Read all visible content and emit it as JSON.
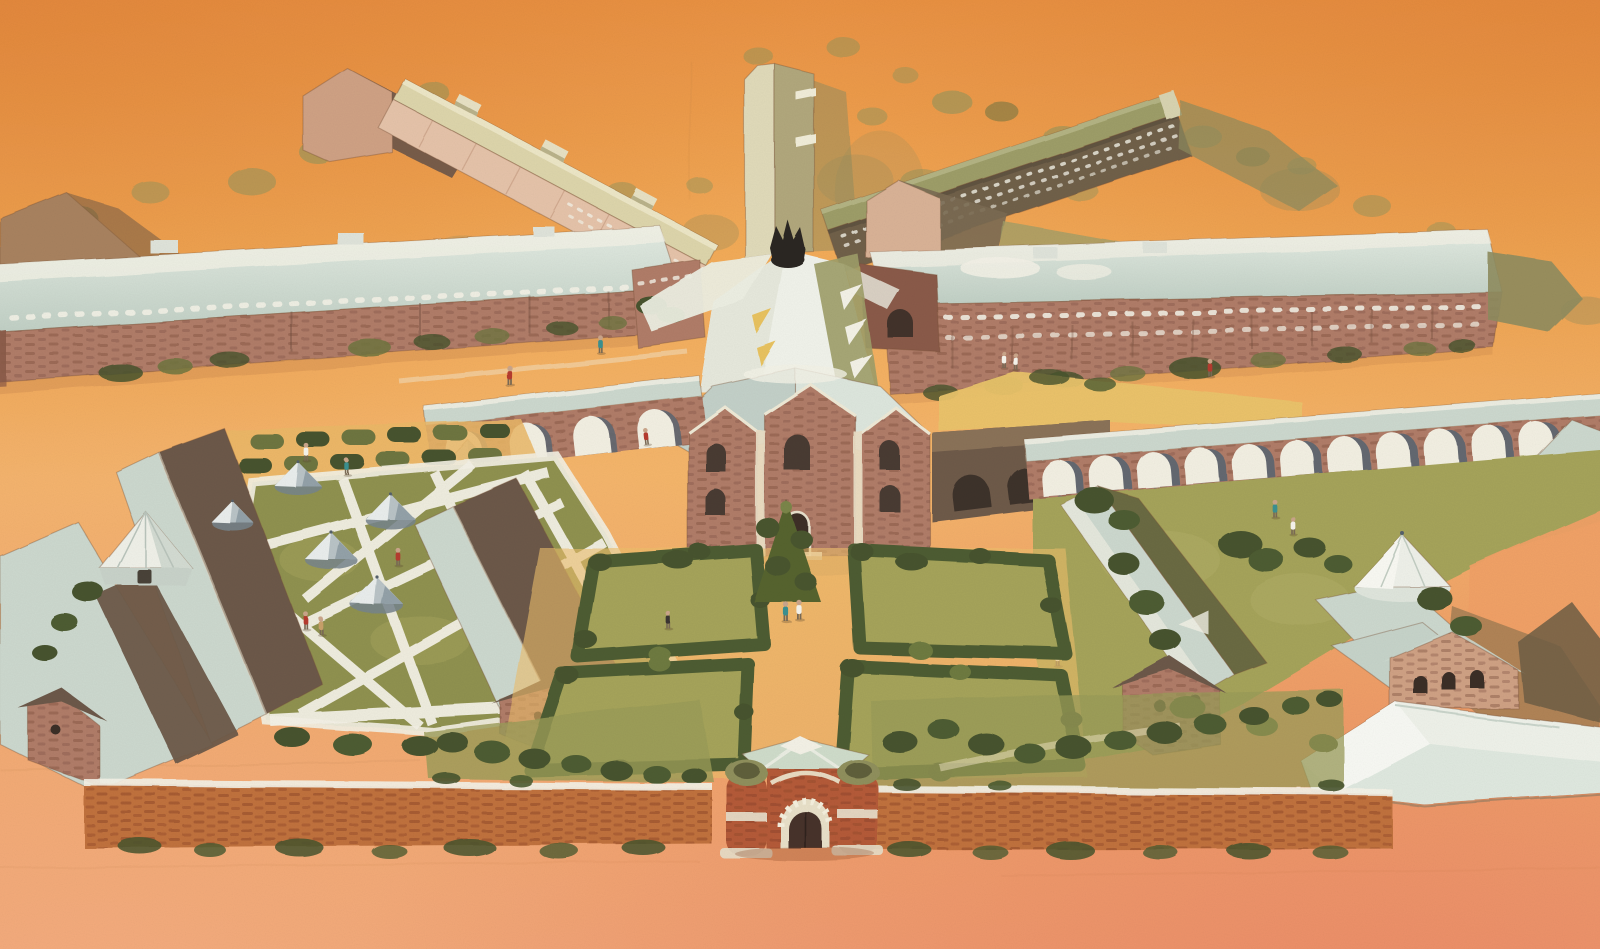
{
  "meta": {
    "alt": "Aerial watercolour illustration of a walled radial prison complex: central watchtower with radiating cell-block wings, long perimeter cell blocks, arcaded inner walls, a brick chapel, formal hedged gardens, a zig-zag exercise yard with round tents, workshop buildings, and a turreted brick gatehouse in the south wall"
  },
  "scene": {
    "elements": [
      "central-watchtower",
      "radial-cell-block-wings",
      "west-perimeter-cell-block",
      "east-perimeter-cell-block",
      "chapel",
      "left-arcade-wall",
      "right-arcade-wall",
      "formal-garden-beds",
      "central-garden-tree",
      "zigzag-exercise-yard",
      "round-canvas-tents",
      "octagonal-pavilion",
      "workshop-buildings",
      "white-hipped-roof-building",
      "south-perimeter-wall",
      "gatehouse",
      "orchard-hedge-rows",
      "scattered-trees",
      "walking-figures"
    ],
    "garden_beds": 4,
    "gray_tents": 5,
    "white_pavilions": 2,
    "right_arcade_arches": 11,
    "left_arcade_arches": 4,
    "figure_count": 19,
    "gatehouses": 1
  },
  "palette": {
    "sky_top": "#e88f41",
    "sky_hi": "#f2ab58",
    "sky_mid": "#f4b56b",
    "ground_mid": "#f0a967",
    "ground_low": "#efa173",
    "corner_shade": "#dd7f35",
    "fore_peach": "#f4ad7e",
    "fore_salmon": "#eb8a66",
    "roof_pale": "#ccd8ce",
    "roof_pale_hi": "#e6ede5",
    "roof_white": "#f0f2ea",
    "roof_cream": "#ddd5ab",
    "roof_olive": "#9d9d68",
    "roof_dark": "#6c5949",
    "tower_light": "#e0dab9",
    "tower_shade": "#b1a77b",
    "brick_mid": "#b07c68",
    "brick_light": "#cfa184",
    "brick_dark": "#8a5a48",
    "brick_red": "#c0713d",
    "gate_brick": "#b45a38",
    "facade_dark": "#70604a",
    "facade_pink": "#e5c3a9",
    "arch_shadow": "#5c6671",
    "arch_dark": "#3b2f28",
    "tree_olive": "#93945a",
    "tree_olive_dark": "#6e7440",
    "tree_dark": "#47532d",
    "hedge_dark": "#4d5c31",
    "lawn_green": "#a5a35a",
    "yard_green": "#8f9150",
    "lawn_gold": "#e9c36a",
    "garden_tan": "#ecbe6a",
    "orchard_tan": "#eab766",
    "path_white": "#f2efe2",
    "white_band": "#f3f1e6",
    "shadow_olive": "#8e8c5e",
    "fig_red": "#b53a2e",
    "fig_teal": "#3a9090",
    "fig_white": "#f6f4ec",
    "fig_tan": "#c9a06a",
    "fig_dark": "#3a3530"
  }
}
